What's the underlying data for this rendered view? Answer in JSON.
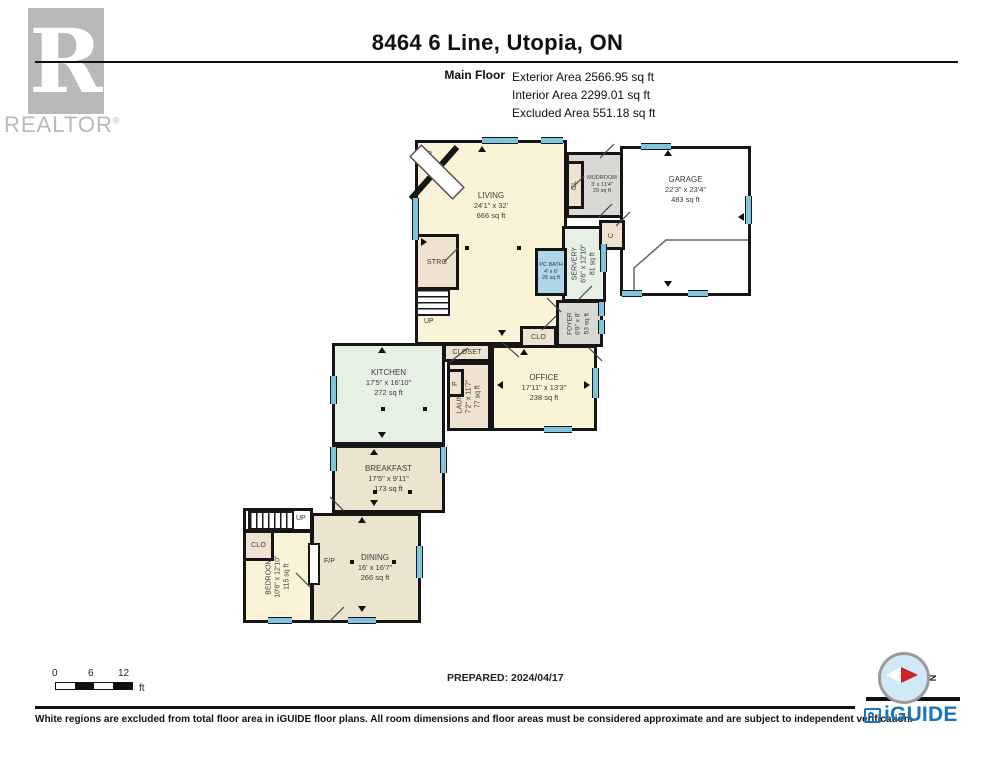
{
  "header": {
    "title": "8464 6 Line, Utopia, ON",
    "floor_label": "Main Floor",
    "stats": {
      "exterior": "Exterior Area 2566.95 sq ft",
      "interior": "Interior Area 2299.01 sq ft",
      "excluded": "Excluded Area 551.18 sq ft"
    },
    "realtor": {
      "letter": "R",
      "word": "REALTOR",
      "reg": "®"
    }
  },
  "rooms": {
    "living": {
      "name": "LIVING",
      "dims": "24'1\" x 32'",
      "area": "666 sq ft"
    },
    "kitchen": {
      "name": "KITCHEN",
      "dims": "17'5\" x 16'10\"",
      "area": "272 sq ft"
    },
    "breakfast": {
      "name": "BREAKFAST",
      "dims": "17'5\" x 9'11\"",
      "area": "173 sq ft"
    },
    "dining": {
      "name": "DINING",
      "dims": "16' x 16'7\"",
      "area": "266 sq ft"
    },
    "bedroom": {
      "name": "BEDROOM",
      "dims": "10'6\" x 12'10\"",
      "area": "115 sq ft"
    },
    "office": {
      "name": "OFFICE",
      "dims": "17'11\" x 13'3\"",
      "area": "238 sq ft"
    },
    "laundry": {
      "name": "LAUNDRY",
      "dims": "7'2\" x 11'7\"",
      "area": "77 sq ft"
    },
    "servery": {
      "name": "SERVERY",
      "dims": "6'6\" x 12'10\"",
      "area": "81 sq ft"
    },
    "foyer": {
      "name": "FOYER",
      "dims": "6'9\" x 8'",
      "area": "53 sq ft"
    },
    "pc_bath": {
      "name": "PC BATH",
      "dims": "4' x 6'",
      "area": "26 sq ft"
    },
    "mudroom": {
      "name": "MUDROOM",
      "dims": "3' x 11'4\"",
      "area": "29 sq ft"
    },
    "garage": {
      "name": "GARAGE",
      "dims": "22'3\" x 23'4\"",
      "area": "483 sq ft"
    }
  },
  "labels": {
    "fp": "F/P",
    "up": "UP",
    "strg": "STRG",
    "cl": "CL",
    "c": "C",
    "p": "P",
    "clo": "CLO",
    "closet": "CLOSET"
  },
  "scale_bar": {
    "t0": "0",
    "t6": "6",
    "t12": "12",
    "unit": "ft"
  },
  "compass": {
    "north": "N"
  },
  "footer": {
    "prepared": "PREPARED: 2024/04/17",
    "disclaimer": "White regions are excluded from total floor area in iGUIDE floor plans. All room dimensions and floor areas must be considered approximate and are subject to independent verification.",
    "brand": "iGUIDE"
  },
  "colors": {
    "window": "#7fc3dc",
    "brand_blue": "#1b75bb",
    "wall": "#151515"
  }
}
